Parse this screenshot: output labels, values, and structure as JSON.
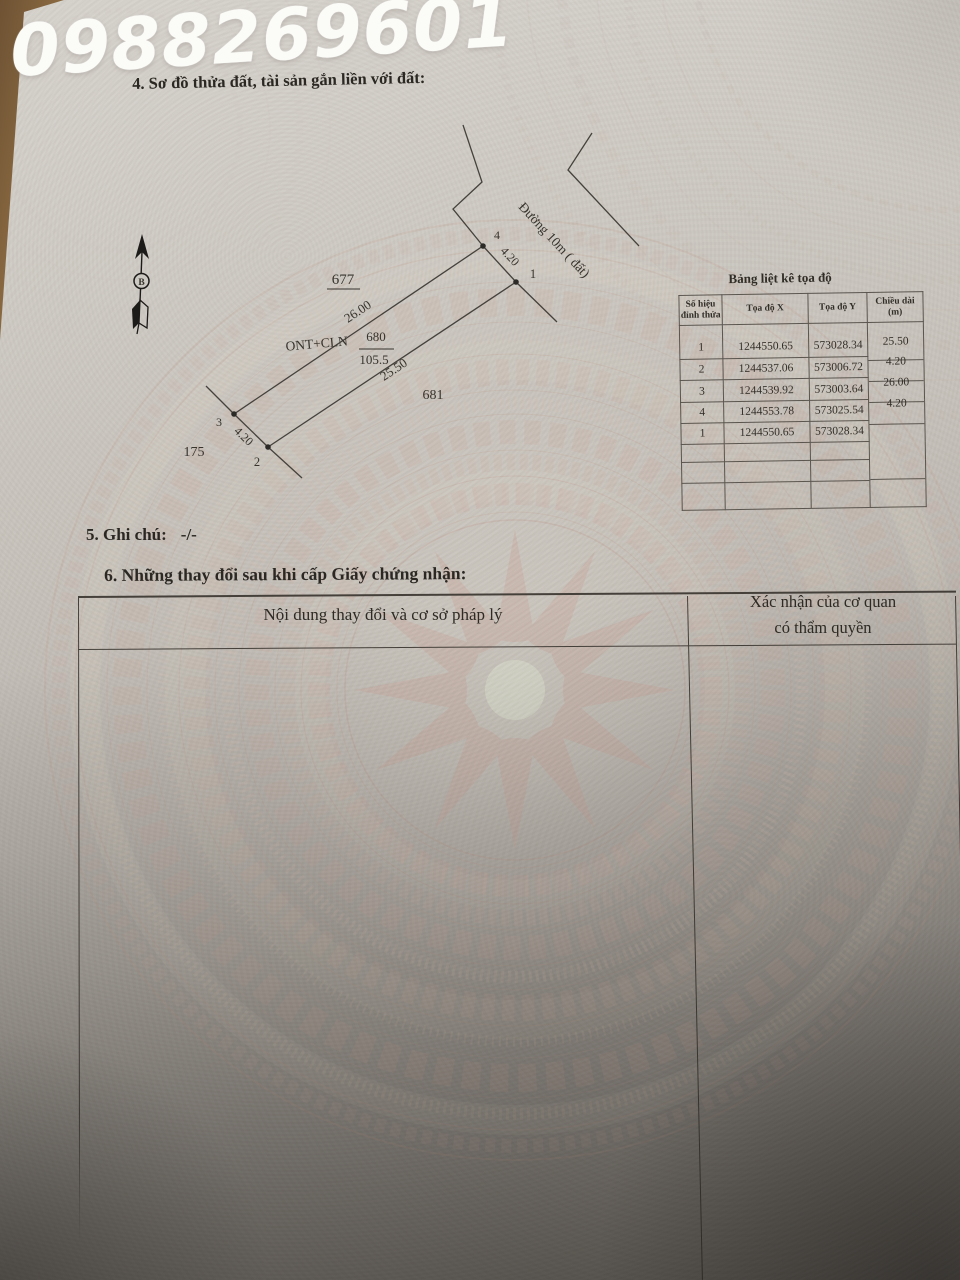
{
  "overlay": {
    "phone": "0988269601"
  },
  "section4": {
    "heading": "4. Sơ đồ thửa đất, tài sản gắn liền với đất:"
  },
  "diagram": {
    "north_label": "B",
    "road_label": "Đường 10m ( đất)",
    "labels": {
      "parcel_677": "677",
      "parcel_681": "681",
      "parcel_175": "175",
      "land_use": "ONT+CLN",
      "parcel_680": "680",
      "area_680": "105.5",
      "len_top_edge": "26.00",
      "len_front_edge": "25.50",
      "len_right_side": "4.20",
      "len_left_side": "4.20",
      "vertex_1": "1",
      "vertex_2": "2",
      "vertex_3": "3",
      "vertex_4": "4"
    }
  },
  "coord_table": {
    "title": "Bảng liệt kê tọa độ",
    "headers": {
      "vertex": "Số hiệu đỉnh thửa",
      "x": "Tọa độ X",
      "y": "Tọa độ Y",
      "length": "Chiều dài (m)"
    },
    "rows": [
      {
        "v": "1",
        "x": "1244550.65",
        "y": "573028.34"
      },
      {
        "v": "2",
        "x": "1244537.06",
        "y": "573006.72"
      },
      {
        "v": "3",
        "x": "1244539.92",
        "y": "573003.64"
      },
      {
        "v": "4",
        "x": "1244553.78",
        "y": "573025.54"
      },
      {
        "v": "1",
        "x": "1244550.65",
        "y": "573028.34"
      }
    ],
    "lengths": [
      "25.50",
      "4.20",
      "26.00",
      "4.20"
    ]
  },
  "section5": {
    "label": "5. Ghi chú:",
    "value": "-/-"
  },
  "section6": {
    "heading": "6. Những thay đổi sau khi cấp Giấy chứng nhận:",
    "col1_header": "Nội dung thay đổi và cơ sở pháp lý",
    "col2_header_line1": "Xác nhận của cơ quan",
    "col2_header_line2": "có thẩm quyền"
  },
  "colors": {
    "ink": "#322e28",
    "paper_light": "#d6d2cc",
    "paper_dark": "#7e7a74",
    "watermark_pink": "#c8aba0",
    "watermark_cream": "#e2d8c6",
    "wood": "#7b5c38"
  }
}
